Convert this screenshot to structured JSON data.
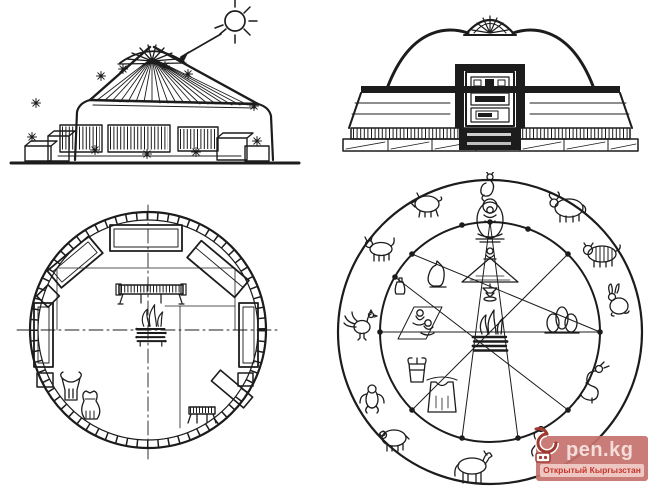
{
  "canvas": {
    "width": 650,
    "height": 488,
    "background": "#ffffff",
    "ink": "#1c1c1c"
  },
  "figures": {
    "cross_section": {
      "icons": [
        "sun-icon",
        "sunray-arrow-icon",
        "roof-crown-icon",
        "roof-pole-icon",
        "light-starburst-icon",
        "chest-icon",
        "bench-icon"
      ]
    },
    "front_elevation": {
      "icons": [
        "dome-crown-icon",
        "ornate-door-icon",
        "eave-band-icon",
        "base-platform-icon"
      ]
    },
    "floor_plan": {
      "icons": [
        "lattice-wall-ring-icon",
        "axis-crosshair-icon",
        "chest-icon",
        "bed-icon",
        "bench-icon",
        "low-table-icon",
        "hearth-icon",
        "saddle-icon",
        "leather-bag-icon",
        "small-table-icon"
      ]
    },
    "zodiac_scheme": {
      "animals_clockwise_from_top": [
        "rat",
        "ox",
        "tiger",
        "hare",
        "dragon",
        "snake",
        "horse",
        "sheep",
        "monkey",
        "rooster",
        "dog",
        "pig"
      ],
      "inner_icons": [
        "buddha-icon",
        "seated-figure-icon",
        "altar-lamp-icon",
        "hearth-icon",
        "people-on-mat-icon",
        "bottle-icon",
        "stones-icon",
        "cat-figure-icon",
        "bucket-icon",
        "vest-icon"
      ]
    }
  },
  "watermark": {
    "text": "pen.kg",
    "subtitle": "Открытый Кыргызстан",
    "colors": {
      "box": "#c6726c",
      "text": "#f3dcd9",
      "strip": "#eec7c3",
      "subtitle_text": "#c5352a"
    }
  }
}
